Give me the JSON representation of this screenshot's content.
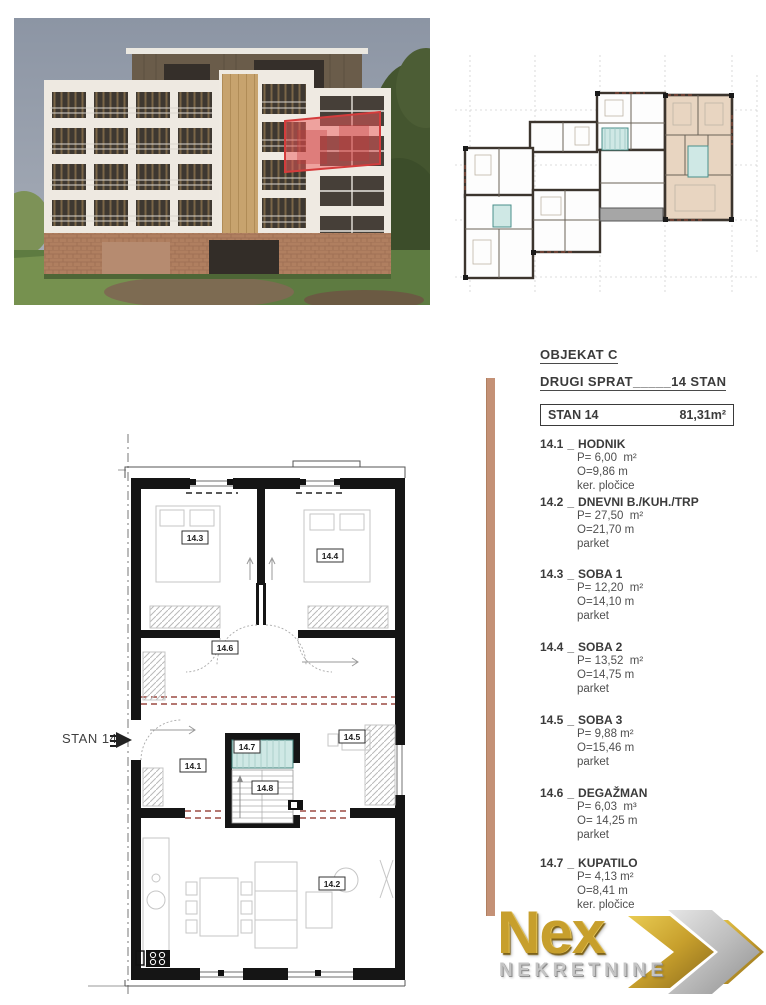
{
  "panel": {
    "object_title": "OBJEKAT C",
    "floor_title": "DRUGI SPRAT_____14 STAN",
    "unit_label": "STAN 14",
    "unit_area": "81,31m²",
    "sep": "_",
    "rooms": [
      {
        "code": "14.1",
        "name": "HODNIK",
        "p": "P= 6,00  m²",
        "o": "O=9,86 m",
        "floor": "ker. pločice"
      },
      {
        "code": "14.2",
        "name": "DNEVNI B./KUH./TRP",
        "p": "P= 27,50  m²",
        "o": "O=21,70 m",
        "floor": "parket"
      },
      {
        "code": "14.3",
        "name": "SOBA 1",
        "p": "P= 12,20  m²",
        "o": "O=14,10 m",
        "floor": "parket"
      },
      {
        "code": "14.4",
        "name": "SOBA 2",
        "p": "P= 13,52  m²",
        "o": "O=14,75 m",
        "floor": "parket"
      },
      {
        "code": "14.5",
        "name": "SOBA 3",
        "p": "P= 9,88 m²",
        "o": "O=15,46 m",
        "floor": "parket"
      },
      {
        "code": "14.6",
        "name": "DEGAŽMAN",
        "p": "P= 6,03  m³",
        "o": "O= 14,25 m",
        "floor": "parket"
      },
      {
        "code": "14.7",
        "name": "KUPATILO",
        "p": "P= 4,13 m²",
        "o": "O=8,41 m",
        "floor": "ker. pločice"
      }
    ]
  },
  "plan": {
    "entrance_label": "STAN 14",
    "labels": {
      "r141": "14.1",
      "r142": "14.2",
      "r143": "14.3",
      "r144": "14.4",
      "r145": "14.5",
      "r146": "14.6",
      "r147": "14.7",
      "r148": "14.8"
    }
  },
  "logo": {
    "brand": "Nex",
    "subtitle": "NEKRETNINE"
  },
  "colors": {
    "highlight_red": "#d43c3c",
    "apartment_fill": "#e8d5c1",
    "divider_tan": "#c49176",
    "bath_teal": "#cfe8e5",
    "logo_gold": "#c79f2c",
    "logo_silver": "#c4c4c4"
  }
}
